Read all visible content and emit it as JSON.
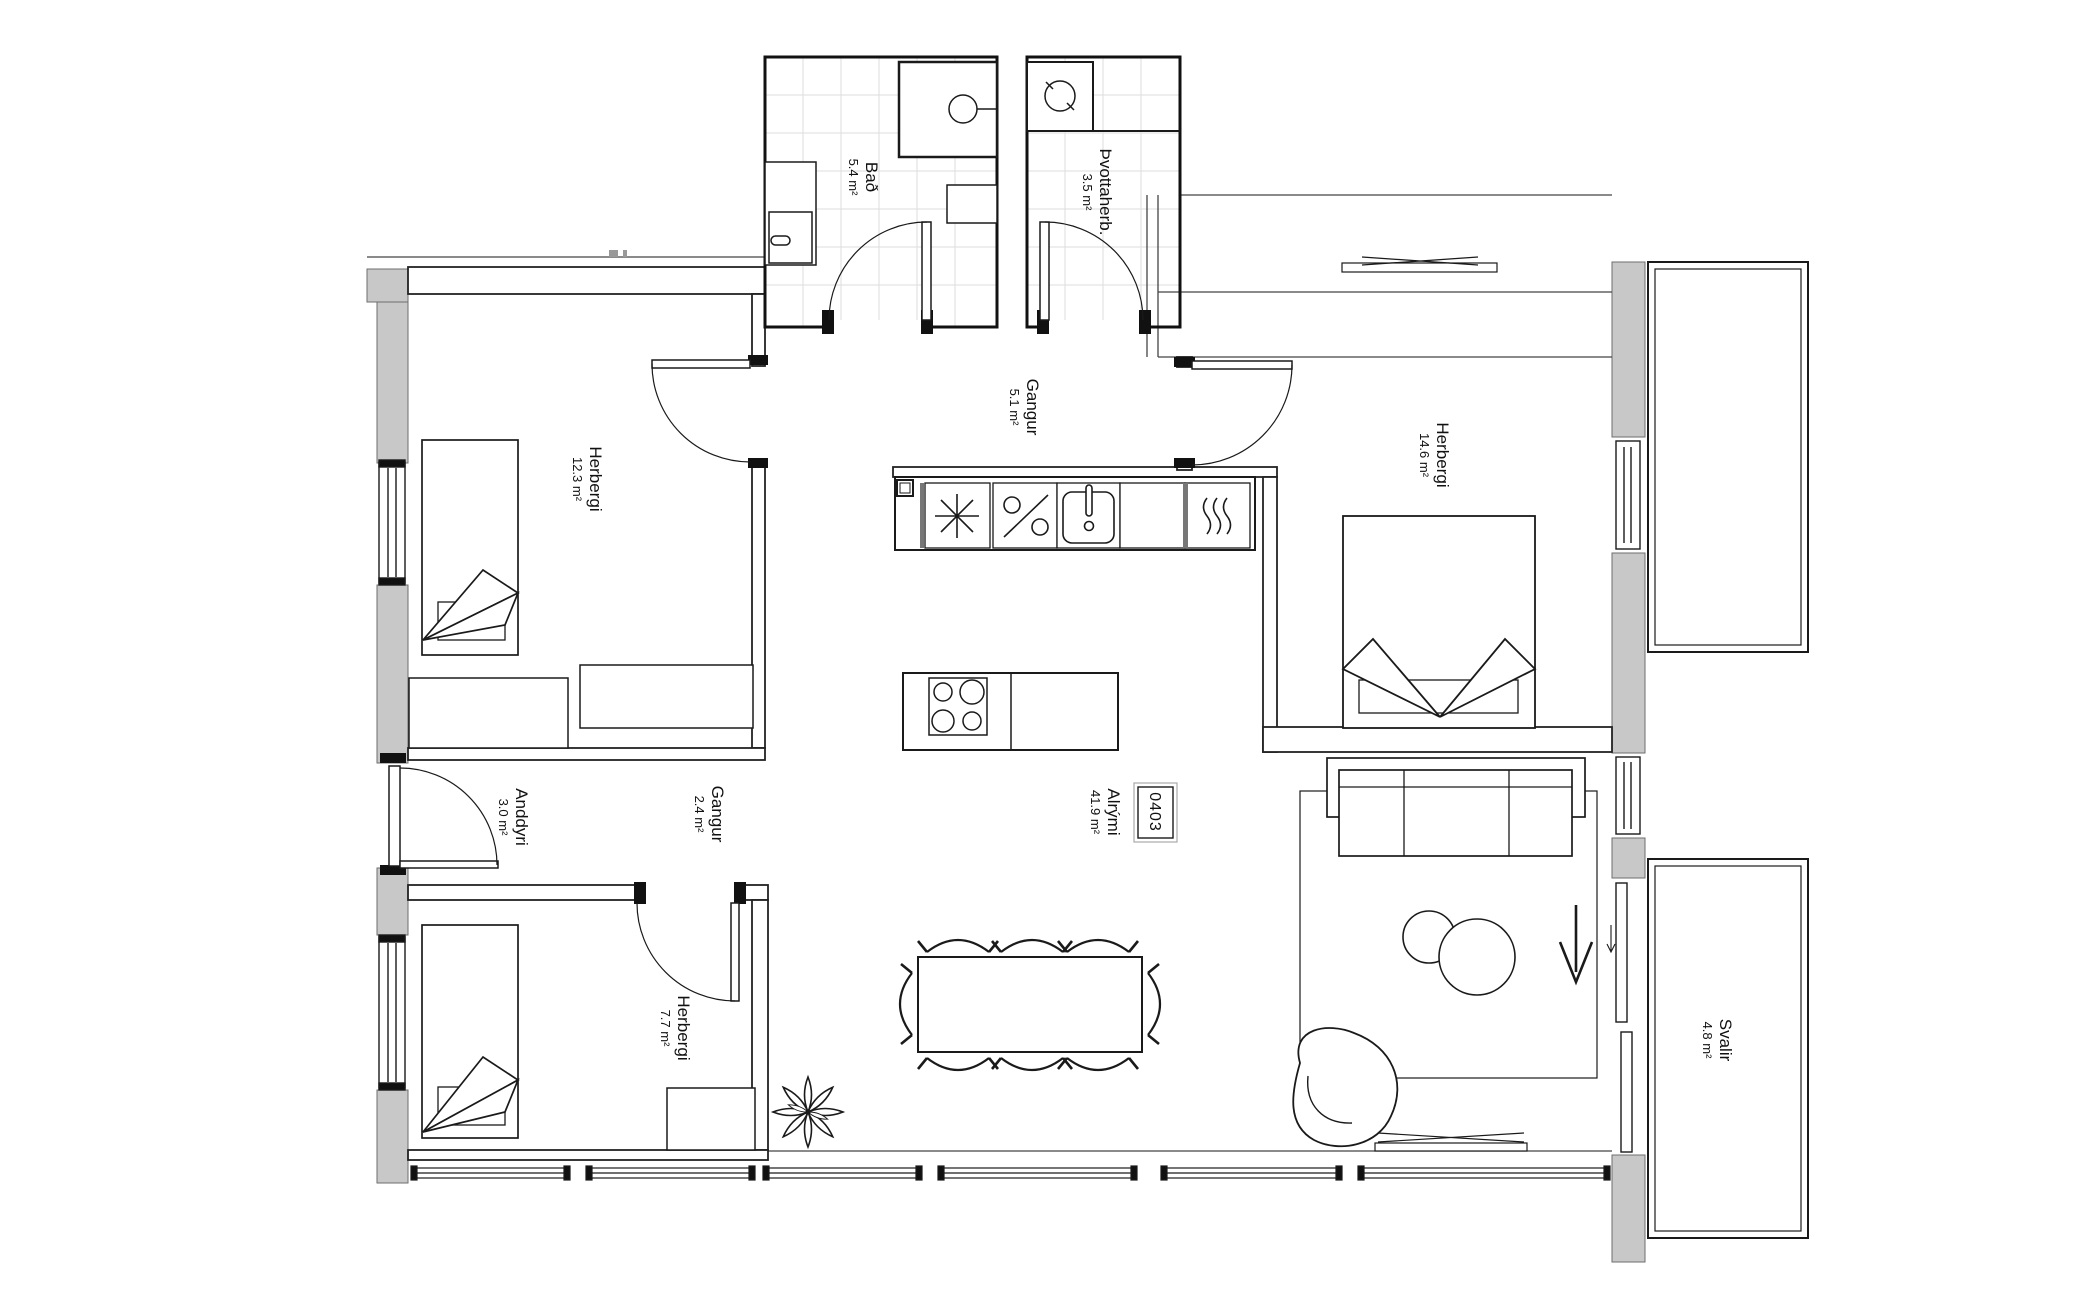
{
  "unit_number": "0403",
  "rooms": [
    {
      "name": "Bað",
      "area": "5.4 m²"
    },
    {
      "name": "Þvottaherb.",
      "area": "3.5 m²"
    },
    {
      "name": "Gangur",
      "area": "5.1 m²"
    },
    {
      "name": "Herbergi",
      "area": "12.3 m²"
    },
    {
      "name": "Herbergi",
      "area": "14.6 m²"
    },
    {
      "name": "Anddyri",
      "area": "3.0 m²"
    },
    {
      "name": "Gangur",
      "area": "2.4 m²"
    },
    {
      "name": "Alrými",
      "area": "41.9 m²"
    },
    {
      "name": "Herbergi",
      "area": "7.7 m²"
    },
    {
      "name": "Svalir",
      "area": "4.8 m²"
    }
  ],
  "colors": {
    "wall_fill": "#c8c8c8",
    "line": "#1a1a1a",
    "tile_line": "#dedede",
    "background": "#ffffff"
  }
}
